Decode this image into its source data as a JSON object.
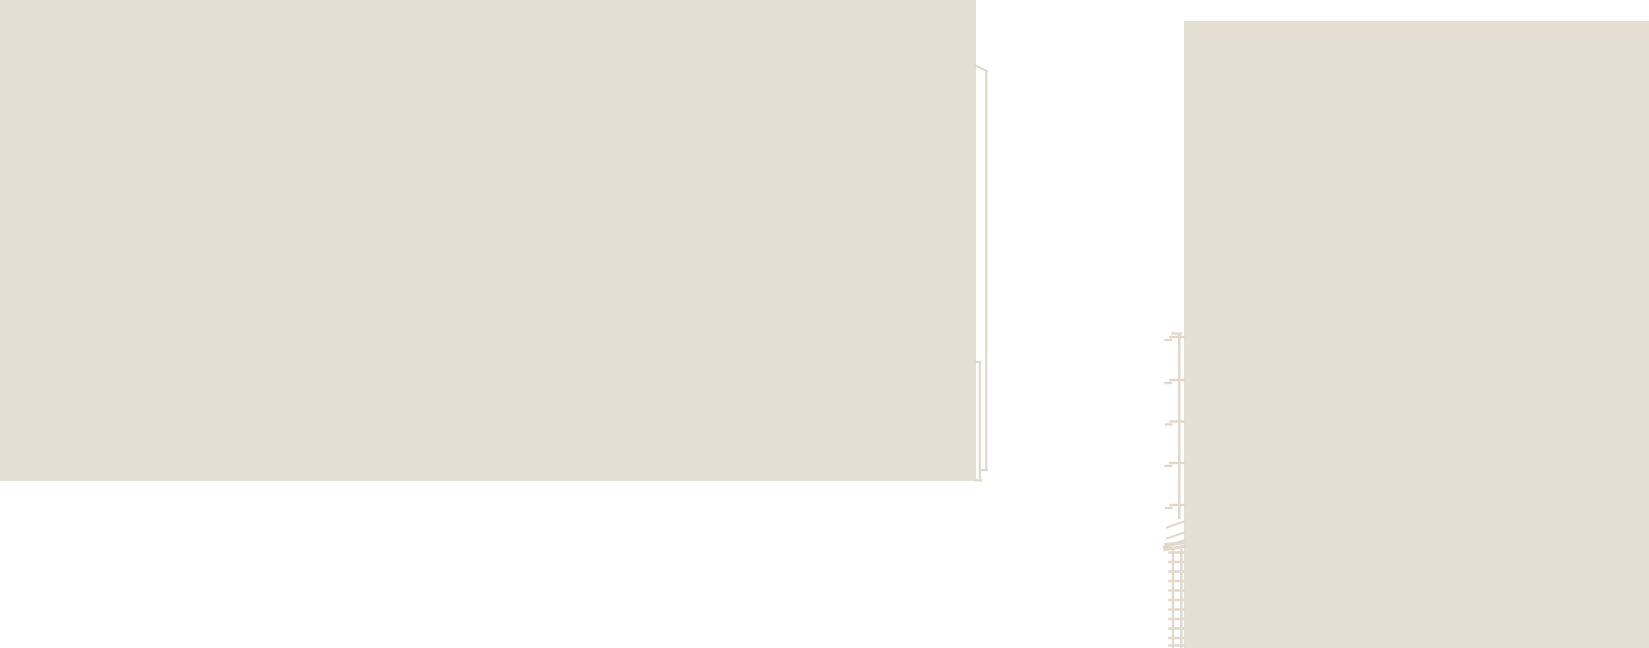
{
  "canvas": {
    "width": 1649,
    "height": 648,
    "background_color": "#ffffff"
  },
  "palette": {
    "panel_fill": "#e5ded3",
    "line_color": "#e2d9cb"
  },
  "left_stack": {
    "front_rect": {
      "x": 0,
      "y": 0,
      "w": 976,
      "h": 481
    },
    "edge_segments": [
      [
        975,
        65.5,
        987,
        71
      ],
      [
        986.3,
        71,
        986.3,
        470
      ],
      [
        979.8,
        470,
        986.8,
        470
      ],
      [
        979.8,
        362,
        979.8,
        480.5
      ],
      [
        975,
        362,
        980.3,
        362
      ],
      [
        975,
        480.3,
        981,
        480.3
      ]
    ]
  },
  "right_panel": {
    "rect": {
      "x": 1184,
      "y": 21,
      "w": 465,
      "h": 627
    },
    "coil": {
      "mast_and_ticks": [
        [
          1179.3,
          334,
          1179.3,
          518
        ],
        [
          1172.5,
          333.5,
          1181,
          333.5
        ],
        [
          1170.5,
          337,
          1184,
          337
        ],
        [
          1165.5,
          340,
          1171,
          340
        ],
        [
          1170.5,
          380,
          1184,
          380
        ],
        [
          1165.5,
          383,
          1171,
          383
        ],
        [
          1170.5,
          421.5,
          1184,
          421.5
        ],
        [
          1166,
          424.5,
          1171.5,
          424.5
        ],
        [
          1170,
          463,
          1184,
          463
        ],
        [
          1165.5,
          466,
          1171,
          466
        ],
        [
          1170.5,
          505,
          1184,
          505
        ],
        [
          1166,
          508,
          1171.5,
          508
        ]
      ],
      "slant_segments": [
        [
          1167,
          527.5,
          1184,
          521.5
        ],
        [
          1167,
          538.5,
          1184,
          532.5
        ]
      ],
      "scribble_segments": [
        [
          1164.5,
          547,
          1184,
          541
        ],
        [
          1166,
          544.5,
          1182.5,
          543
        ],
        [
          1165,
          549.5,
          1184,
          546.5
        ]
      ],
      "ladder_segments": [
        [
          1173,
          550,
          1173,
          646.5
        ],
        [
          1181.3,
          550,
          1181.3,
          646.5
        ],
        [
          1169.5,
          552.5,
          1183.5,
          552.5
        ],
        [
          1169.5,
          562,
          1183.5,
          562
        ],
        [
          1169.5,
          571.5,
          1183.5,
          571.5
        ],
        [
          1169.5,
          581,
          1183.5,
          581
        ],
        [
          1169.5,
          590.5,
          1183.5,
          590.5
        ],
        [
          1169.5,
          600,
          1183.5,
          600
        ],
        [
          1169.5,
          609.5,
          1183.5,
          609.5
        ],
        [
          1169.5,
          619,
          1183.5,
          619
        ],
        [
          1169.5,
          628.5,
          1183.5,
          628.5
        ],
        [
          1169.5,
          638,
          1183.5,
          638
        ],
        [
          1169.5,
          645.5,
          1184,
          645.5
        ]
      ]
    }
  }
}
